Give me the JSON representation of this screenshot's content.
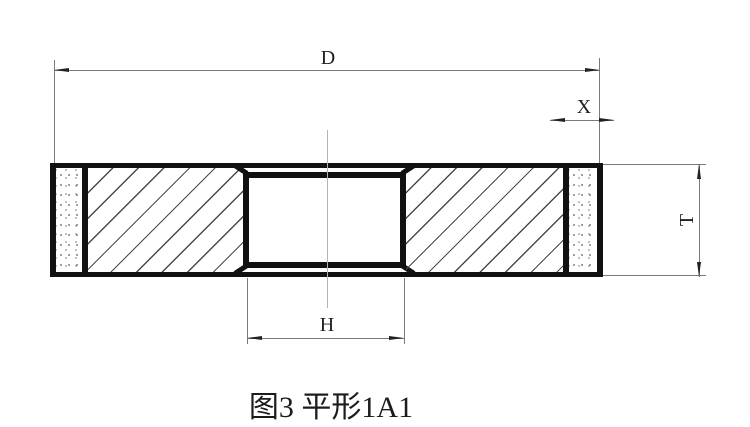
{
  "drawing": {
    "caption": "图3 平形1A1",
    "dimensions": {
      "diameter": "D",
      "abrasive_depth": "X",
      "thickness": "T",
      "bore": "H"
    }
  },
  "colors": {
    "outline": "#111111",
    "dimension_line": "#7a7a7a",
    "arrow": "#222222",
    "centerline": "#b3b3b3",
    "background": "#ffffff"
  }
}
